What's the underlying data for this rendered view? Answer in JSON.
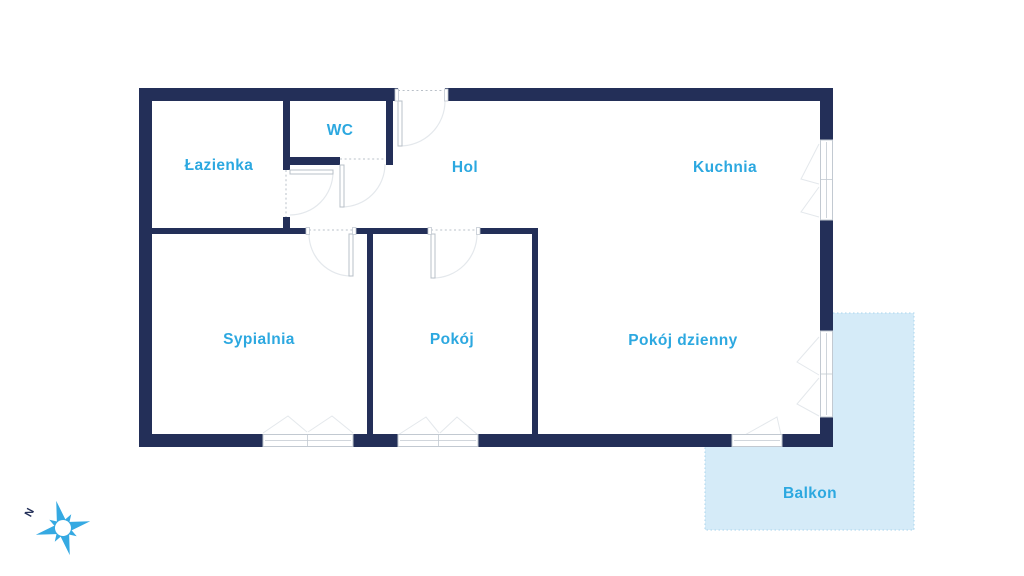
{
  "theme": {
    "wall": "#232f58",
    "label_text": "#2ca8e0",
    "balcony_fill": "#d5ebf8",
    "balcony_border": "#a9d4ec",
    "door_arc": "#e4e8ec",
    "window_frame": "#c2c9d1",
    "opening_dash": "#b9c0c8",
    "compass_star": "#35a9e2",
    "background": "#ffffff"
  },
  "rooms": [
    {
      "id": "lazienka",
      "label": "Łazienka"
    },
    {
      "id": "wc",
      "label": "WC"
    },
    {
      "id": "hol",
      "label": "Hol"
    },
    {
      "id": "kuchnia",
      "label": "Kuchnia"
    },
    {
      "id": "sypialnia",
      "label": "Sypialnia"
    },
    {
      "id": "pokoj",
      "label": "Pokój"
    },
    {
      "id": "pokoj-dzienny",
      "label": "Pokój dzienny"
    },
    {
      "id": "balkon",
      "label": "Balkon"
    }
  ],
  "compass": {
    "north_label": "N"
  }
}
